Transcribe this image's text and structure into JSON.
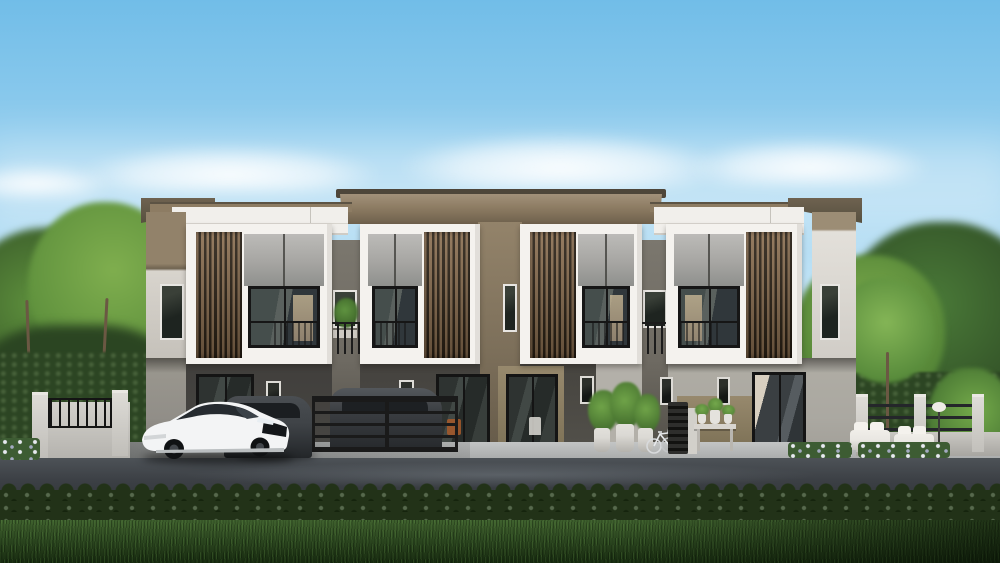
{
  "meta": {
    "image_type": "photorealistic architectural exterior rendering",
    "subject": "Row of four modern two-storey townhouses, front elevation, daytime",
    "visible_text": "none"
  },
  "scene": {
    "sky": {
      "condition": "clear blue with soft white clouds"
    },
    "building": {
      "storeys": 2,
      "style": "modern flat-roof townhouses, white box frames with brown vertical slat screens",
      "units": [
        {
          "label": "unit-1",
          "slat_screen_side": "left",
          "ground_floor": "carport with glass door, two cars parked in front"
        },
        {
          "label": "unit-2",
          "slat_screen_side": "right",
          "ground_floor": "sliding glass door behind black metal gate"
        },
        {
          "label": "unit-3",
          "slat_screen_side": "left",
          "ground_floor": "sliding glass door, potted plants and bicycle"
        },
        {
          "label": "unit-4",
          "slat_screen_side": "right",
          "ground_floor": "sliding glass door, bench with plant pots, garden seating"
        }
      ]
    },
    "vehicles": [
      {
        "label": "white-sedan",
        "position": "front-left"
      },
      {
        "label": "dark-gray-car",
        "position": "beside white sedan"
      },
      {
        "label": "dark-car-behind-gate",
        "position": "behind black gate"
      }
    ],
    "landscape": [
      "tall green trees on left and right",
      "low concrete boundary wall with black metal railing on left",
      "concrete-post metal fence with hedge on right",
      "outdoor white sofa set with lamp on right lawn",
      "white flower beds",
      "concrete apron and asphalt road",
      "long trimmed hedge strip and lawn grass in foreground"
    ]
  },
  "colors": {
    "sky_top": "#71bde8",
    "sky_mid": "#9ed3f0",
    "sky_low": "#d8eefa",
    "sky_horizon": "#eef8fd",
    "roof_lip": "#4e463a",
    "roof_brown": "#8d7c63",
    "roof_brown_dark": "#6e604c",
    "parapet": "#f1efeb",
    "frame_white": "#f4f2ee",
    "slat_brown": "#8a6e50",
    "slat_gap": "#2b2115",
    "glass_gray": "#a6a5a2",
    "glass_dark": "#30373b",
    "mullion": "#161616",
    "interior_warm": "#c8b795",
    "wing_taupe": "#92826a",
    "wing_light": "#d8d4cd",
    "mid_taupe": "#93836a",
    "recess_gray": "#6e6a62",
    "ground_dark": "#474643",
    "ground_mid": "#918e88",
    "ground_light": "#c4c1ba",
    "khaki": "#97896d",
    "metal_black": "#1a1a1a",
    "concrete": "#c3c5c5",
    "road_top": "#4d5257",
    "road_bottom": "#303438",
    "hedge_dark": "#223218",
    "hedge_wall": "#2c4523",
    "grass_light": "#3f612e",
    "grass_dark": "#16290f",
    "tree_bright": "#7fae4e",
    "tree_mid": "#5d8f3c",
    "tree_dark": "#2b4522",
    "trunk": "#6b5843",
    "car_white": "#f3f4f5",
    "car_dark": "#3f4347",
    "pot_white": "#dbd9d4",
    "cushion_white": "#e9e7e2"
  }
}
